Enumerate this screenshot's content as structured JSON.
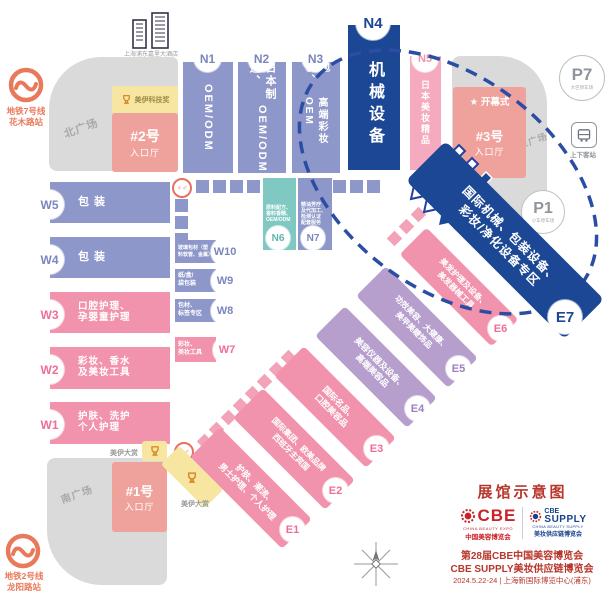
{
  "title": "展馆示意图",
  "plazas": {
    "north": "北广场",
    "south": "南广场",
    "east": "东广场"
  },
  "landmarks": {
    "hotel": "上海浦东嘉里大酒店"
  },
  "metro": {
    "line7": [
      "地铁7号线",
      "花木路站"
    ],
    "line2": [
      "地铁2号线",
      "龙阳路站"
    ]
  },
  "entrances": {
    "no2": {
      "name": "#2号",
      "hall": "入口厅"
    },
    "no3": {
      "name": "#3号",
      "hall": "入口厅",
      "ceremony": "★ 开幕式"
    },
    "no1": {
      "name": "#1号",
      "hall": "入口厅"
    }
  },
  "awards": {
    "tech": "美伊科技奖",
    "grand_w": "美伊大赏",
    "grand_s": "美伊大赏"
  },
  "parking": {
    "p7": {
      "id": "P7",
      "note": "大巴停车场"
    },
    "p1": {
      "id": "P1",
      "note": "小车停车场"
    },
    "pickup": "上下客站"
  },
  "halls": {
    "N1": {
      "id": "N1",
      "lines": [
        "OEM/ODM"
      ]
    },
    "N2": {
      "id": "N2",
      "lines": [
        "日本制造、",
        "OEM/ODM"
      ]
    },
    "N3": {
      "id": "N3",
      "lines": [
        "包装、",
        "高端彩妆OEM"
      ]
    },
    "N4": {
      "id": "N4",
      "label": "机械设备"
    },
    "N5": {
      "id": "N5",
      "label": "日本美妆精品"
    },
    "N6": {
      "id": "N6",
      "lines": [
        "原料配方、",
        "香料香精、",
        "OEM/ODM"
      ]
    },
    "N7": {
      "id": "N7",
      "lines": [
        "精油芳疗",
        "及代加工、",
        "检测认证",
        "配套服务"
      ]
    },
    "W1": {
      "id": "W1",
      "lines": [
        "护肤、洗护",
        "个人护理"
      ]
    },
    "W2": {
      "id": "W2",
      "lines": [
        "彩妆、香水",
        "及美妆工具"
      ]
    },
    "W3": {
      "id": "W3",
      "lines": [
        "口腔护理、",
        "孕婴童护理"
      ]
    },
    "W4": {
      "id": "W4",
      "label": "包 装"
    },
    "W5": {
      "id": "W5",
      "label": "包 装"
    },
    "W7": {
      "id": "W7",
      "lines": [
        "彩妆、",
        "美妆工具"
      ]
    },
    "W8": {
      "id": "W8",
      "lines": [
        "包材、",
        "标签专区"
      ]
    },
    "W9": {
      "id": "W9",
      "lines": [
        "纸/盒/",
        "袋包装"
      ]
    },
    "W10": {
      "id": "W10",
      "lines": [
        "玻璃包材（塑",
        "料软管、金属）"
      ]
    },
    "E1": {
      "id": "E1",
      "lines": [
        "护肤、潮流、",
        "男士护理、个人护理"
      ]
    },
    "E2": {
      "id": "E2",
      "lines": [
        "国际集团、欧美品牌",
        "西班牙主宾国"
      ]
    },
    "E3": {
      "id": "E3",
      "lines": [
        "国际名品、",
        "口腔美容品"
      ]
    },
    "E4": {
      "id": "E4",
      "lines": [
        "美容仪器及设备、",
        "高端美容品"
      ]
    },
    "E5": {
      "id": "E5",
      "lines": [
        "功效美容、大健康、",
        "美甲美睫饰品"
      ]
    },
    "E6": {
      "id": "E6",
      "lines": [
        "美发护理及设备、",
        "美发器械工具"
      ]
    },
    "E7": {
      "id": "E7",
      "lines": [
        "国际机械、包装设备、",
        "彩妆/净化设备专区"
      ]
    }
  },
  "footer": {
    "cbe": {
      "brand": "CBE",
      "en": "CHINA BEAUTY EXPO",
      "cn": "中国美容博览会"
    },
    "supply": {
      "brand": "CBE",
      "brand2": "SUPPLY",
      "en": "CHINA BEAUTY SUPPLY",
      "cn": "美妆供应链博览会"
    },
    "line1": "第28届CBE中国美容博览会",
    "line2": "CBE SUPPLY美妆供应链博览会",
    "line3": "2024.5.22-24 | 上海新国际博览中心(浦东)"
  },
  "colors": {
    "accent_blue": "#1c4795",
    "accent_pink": "#f193ac",
    "accent_purple": "#8e97c9",
    "accent_red": "#b8372c"
  }
}
